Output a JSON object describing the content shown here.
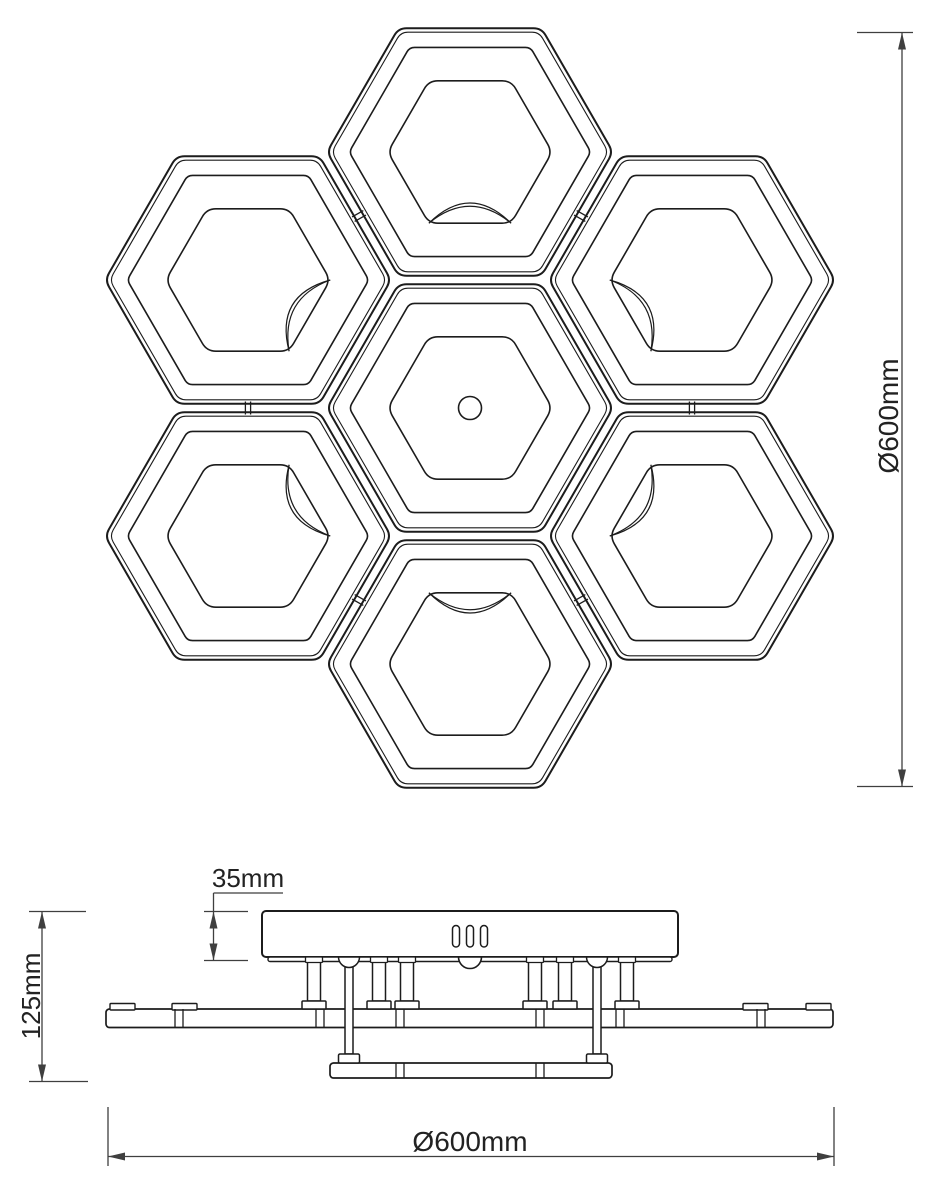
{
  "drawing": {
    "title": "hexagon-honeycomb-ceiling-lamp-technical-drawing",
    "background": "#ffffff",
    "line_color": "#1c1c1c",
    "dim_color": "#3f3f3f"
  },
  "top_view": {
    "hex_radius": 143,
    "rings": [
      {
        "name": "outer-outline",
        "scale": 1.0,
        "corner": 8,
        "width": 2.0
      },
      {
        "name": "edge-offset",
        "scale": 0.967,
        "corner": 7,
        "width": 1.1
      },
      {
        "name": "frame-inner",
        "scale": 0.845,
        "corner": 5,
        "width": 1.6
      },
      {
        "name": "led-panel",
        "scale": 0.575,
        "corner": 9,
        "width": 1.6
      }
    ],
    "modules": [
      {
        "id": "center",
        "cx": 470,
        "cy": 408,
        "center_hole": true
      },
      {
        "id": "top",
        "cx": 470,
        "cy": 152
      },
      {
        "id": "upper-right",
        "cx": 692,
        "cy": 280
      },
      {
        "id": "lower-right",
        "cx": 692,
        "cy": 536
      },
      {
        "id": "bottom",
        "cx": 470,
        "cy": 664
      },
      {
        "id": "lower-left",
        "cx": 248,
        "cy": 536
      },
      {
        "id": "upper-left",
        "cx": 248,
        "cy": 280
      }
    ],
    "center_hole_radius": 11.5,
    "arc": {
      "control1": 0.374,
      "control2": 0.455
    },
    "connectors": [
      [
        "top",
        "upper-left"
      ],
      [
        "top",
        "upper-right"
      ],
      [
        "upper-right",
        "lower-right"
      ],
      [
        "lower-right",
        "bottom"
      ],
      [
        "bottom",
        "lower-left"
      ],
      [
        "lower-left",
        "upper-left"
      ]
    ]
  },
  "side_view": {
    "canopy": {
      "x": 262,
      "y": 911,
      "w": 416,
      "h": 46
    },
    "canopy_lip": {
      "x": 268,
      "y": 957,
      "w": 404,
      "h": 4.5
    },
    "vent_slots": {
      "centers": [
        456,
        470,
        484
      ],
      "y": 925.5,
      "w": 7,
      "h": 21.5
    },
    "center_dome": {
      "cx": 470,
      "cy": 957,
      "r": 11.5
    },
    "posts": {
      "x": [
        314,
        379,
        407,
        535,
        565,
        627
      ],
      "collar_w": 17,
      "collar_h": 5.5,
      "shaft_w": 13,
      "top": 957,
      "bottom": 1001,
      "base_w": 24,
      "base_h": 8
    },
    "rods": {
      "x": [
        349,
        597
      ],
      "dome_r": 10.5,
      "shaft_w": 8,
      "top": 957,
      "bottom": 1054,
      "foot_w": 21,
      "foot_h": 9
    },
    "main_plate": {
      "x": 106,
      "y": 1009,
      "w": 727,
      "h": 18.5,
      "tabs": [
        [
          110,
          25
        ],
        [
          172,
          25
        ],
        [
          743,
          25
        ],
        [
          806,
          25
        ]
      ],
      "tab_h": 6.5,
      "dividers": [
        179,
        320,
        400,
        540,
        620,
        761
      ],
      "divider_gap": 8
    },
    "lower_plate": {
      "x": 330,
      "y": 1063,
      "w": 282,
      "h": 15,
      "dividers": [
        400,
        540
      ],
      "divider_gap": 8
    }
  },
  "dimensions": {
    "canopy_height": {
      "label": "35mm",
      "lines": [
        [
          213.5,
          893,
          213.5,
          960.5
        ],
        [
          213.5,
          893,
          283,
          893
        ],
        [
          204,
          911.5,
          248,
          911.5
        ],
        [
          204,
          960.5,
          248,
          960.5
        ]
      ],
      "arrows": [
        [
          213.5,
          911.5,
          "up"
        ],
        [
          213.5,
          960.5,
          "down"
        ]
      ]
    },
    "total_height": {
      "label": "125mm",
      "lines": [
        [
          42,
          911.5,
          42,
          1081.5
        ],
        [
          29,
          911.5,
          86,
          911.5
        ],
        [
          29,
          1081.5,
          88,
          1081.5
        ]
      ],
      "arrows": [
        [
          42,
          911.5,
          "up"
        ],
        [
          42,
          1081.5,
          "down"
        ]
      ]
    },
    "top_view_diameter": {
      "label": "Ø600mm",
      "lines": [
        [
          902,
          32.5,
          902,
          786.5
        ],
        [
          857,
          32.5,
          913,
          32.5
        ],
        [
          857,
          786.5,
          913,
          786.5
        ]
      ],
      "arrows": [
        [
          902,
          32.5,
          "up"
        ],
        [
          902,
          786.5,
          "down"
        ]
      ]
    },
    "bottom_diameter": {
      "label": "Ø600mm",
      "lines": [
        [
          108,
          1156.5,
          834,
          1156.5
        ],
        [
          108,
          1107,
          108,
          1166
        ],
        [
          834,
          1107,
          834,
          1166
        ]
      ],
      "arrows": [
        [
          108,
          1156.5,
          "left"
        ],
        [
          834,
          1156.5,
          "right"
        ]
      ]
    }
  }
}
